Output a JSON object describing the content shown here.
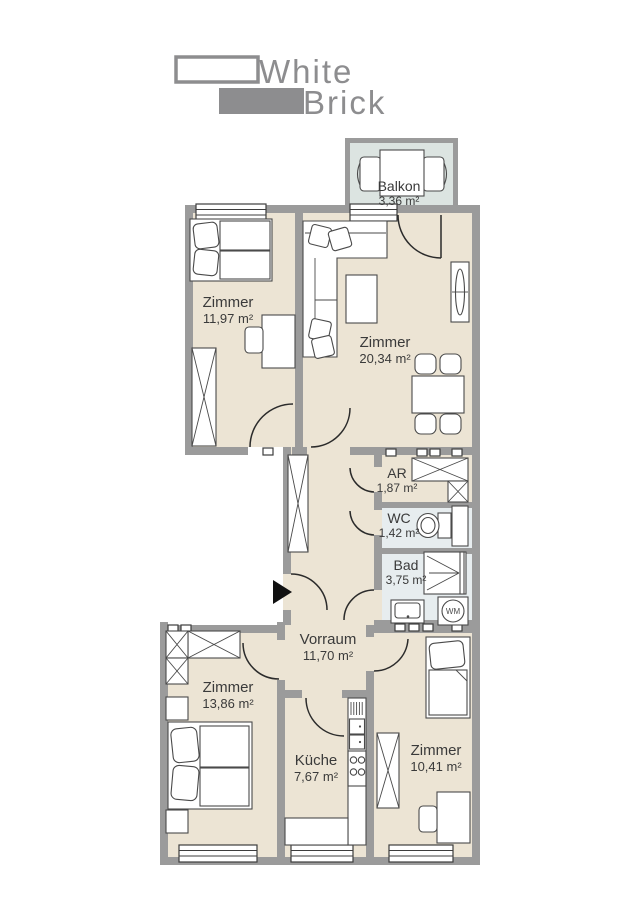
{
  "logo": {
    "word1": "White",
    "word2": "Brick",
    "color": "#8d8d8f"
  },
  "floorplan": {
    "colors": {
      "wall": "#9b9b9b",
      "floor": "#ece4d4",
      "wet_floor": "#e7edef",
      "balcony_floor": "#dce4e1",
      "text": "#3a3a3a",
      "entrance_arrow": "#111111"
    },
    "rooms": {
      "balkon": {
        "name": "Balkon",
        "area": "3,36 m²"
      },
      "zimmer_nw": {
        "name": "Zimmer",
        "area": "11,97 m²"
      },
      "zimmer_ne": {
        "name": "Zimmer",
        "area": "20,34 m²"
      },
      "ar": {
        "name": "AR",
        "area": "1,87 m²"
      },
      "wc": {
        "name": "WC",
        "area": "1,42 m²"
      },
      "bad": {
        "name": "Bad",
        "area": "3,75 m²"
      },
      "vorraum": {
        "name": "Vorraum",
        "area": "11,70 m²"
      },
      "zimmer_sw": {
        "name": "Zimmer",
        "area": "13,86 m²"
      },
      "kueche": {
        "name": "Küche",
        "area": "7,67 m²"
      },
      "zimmer_se": {
        "name": "Zimmer",
        "area": "10,41 m²"
      }
    },
    "appliances": {
      "washing_machine": "WM"
    }
  }
}
